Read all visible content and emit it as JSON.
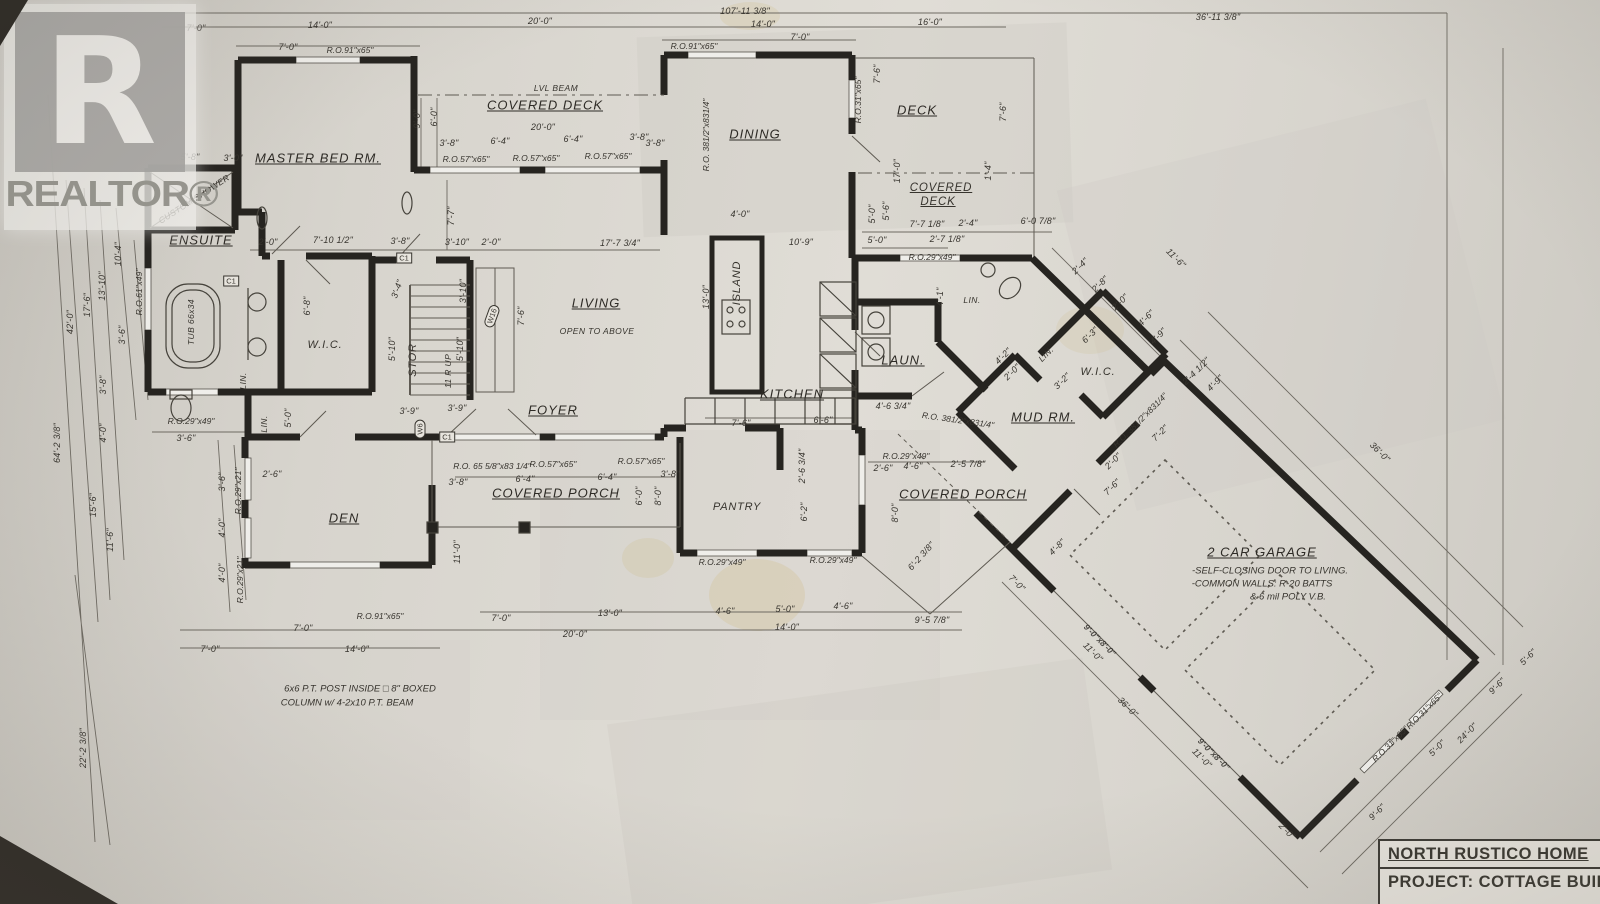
{
  "watermark": {
    "logo_letter": "R",
    "brand": "REALTOR®"
  },
  "title_block": {
    "name": "NORTH RUSTICO HOME",
    "project": "PROJECT: COTTAGE BUILDE"
  },
  "plan": {
    "annotations": [
      {
        "t": "107'-11 3/8\"",
        "x": 745,
        "y": 11
      },
      {
        "t": "7'-0\"",
        "x": 196,
        "y": 28
      },
      {
        "t": "14'-0\"",
        "x": 320,
        "y": 25
      },
      {
        "t": "20'-0\"",
        "x": 540,
        "y": 21
      },
      {
        "t": "14'-0\"",
        "x": 763,
        "y": 24
      },
      {
        "t": "16'-0\"",
        "x": 930,
        "y": 22
      },
      {
        "t": "36'-11 3/8\"",
        "x": 1218,
        "y": 17
      },
      {
        "t": "7'-0\"",
        "x": 288,
        "y": 47
      },
      {
        "t": "R.O.91\"x65\"",
        "x": 350,
        "y": 50,
        "c": "ro"
      },
      {
        "t": "R.O.91\"x65\"",
        "x": 694,
        "y": 46,
        "c": "ro"
      },
      {
        "t": "7'-0\"",
        "x": 800,
        "y": 37
      },
      {
        "t": "LVL BEAM",
        "x": 556,
        "y": 88,
        "c": "sub"
      },
      {
        "t": "COVERED DECK",
        "x": 545,
        "y": 105,
        "c": "room"
      },
      {
        "t": "20'-0\"",
        "x": 543,
        "y": 127
      },
      {
        "t": "3'-8\"",
        "x": 449,
        "y": 143
      },
      {
        "t": "6'-4\"",
        "x": 500,
        "y": 141
      },
      {
        "t": "6'-4\"",
        "x": 573,
        "y": 139
      },
      {
        "t": "3'-8\"",
        "x": 639,
        "y": 137
      },
      {
        "t": "R.O.57\"x65\"",
        "x": 466,
        "y": 159,
        "c": "ro"
      },
      {
        "t": "R.O.57\"x65\"",
        "x": 536,
        "y": 158,
        "c": "ro"
      },
      {
        "t": "R.O.57\"x65\"",
        "x": 608,
        "y": 156,
        "c": "ro"
      },
      {
        "t": "9'-0\"",
        "x": 417,
        "y": 119,
        "r": -90
      },
      {
        "t": "6'-0\"",
        "x": 434,
        "y": 117,
        "r": -90
      },
      {
        "t": "7'-7\"",
        "x": 451,
        "y": 216,
        "r": -90
      },
      {
        "t": "MASTER BED RM.",
        "x": 318,
        "y": 158,
        "c": "room"
      },
      {
        "t": "5'-8\"",
        "x": 190,
        "y": 157
      },
      {
        "t": "3'-0\"",
        "x": 233,
        "y": 158
      },
      {
        "t": "CUSTOM SHOWER",
        "x": 194,
        "y": 199,
        "r": -33,
        "c": "sub"
      },
      {
        "t": "ENSUITE",
        "x": 201,
        "y": 240,
        "c": "room"
      },
      {
        "t": "TUB 66x34",
        "x": 191,
        "y": 322,
        "r": -90,
        "c": "sub"
      },
      {
        "t": "2'-0\"",
        "x": 268,
        "y": 242
      },
      {
        "t": "7'-10 1/2\"",
        "x": 333,
        "y": 240
      },
      {
        "t": "3'-8\"",
        "x": 400,
        "y": 241
      },
      {
        "t": "3'-10\"",
        "x": 457,
        "y": 242
      },
      {
        "t": "2'-0\"",
        "x": 491,
        "y": 242
      },
      {
        "t": "17'-7 3/4\"",
        "x": 620,
        "y": 243
      },
      {
        "t": "W.I.C.",
        "x": 325,
        "y": 345,
        "c": "roomp"
      },
      {
        "t": "6'-8\"",
        "x": 307,
        "y": 306,
        "r": -90
      },
      {
        "t": "LIN.",
        "x": 243,
        "y": 381,
        "r": -90,
        "c": "sub"
      },
      {
        "t": "LIN.",
        "x": 264,
        "y": 424,
        "r": -90,
        "c": "sub"
      },
      {
        "t": "5'-0\"",
        "x": 288,
        "y": 418,
        "r": -90
      },
      {
        "t": "R.O.29\"x49\"",
        "x": 191,
        "y": 421,
        "c": "ro"
      },
      {
        "t": "3'-6\"",
        "x": 186,
        "y": 438
      },
      {
        "t": "9'-0\"",
        "x": 62,
        "y": 106,
        "r": -90
      },
      {
        "t": "42'-0\"",
        "x": 70,
        "y": 322,
        "r": -90
      },
      {
        "t": "17'-6\"",
        "x": 87,
        "y": 305,
        "r": -90
      },
      {
        "t": "13'-10\"",
        "x": 102,
        "y": 286,
        "r": -90
      },
      {
        "t": "10'-4\"",
        "x": 118,
        "y": 254,
        "r": -90
      },
      {
        "t": "R.O.61\"x49\"",
        "x": 139,
        "y": 292,
        "r": -90,
        "c": "ro"
      },
      {
        "t": "3'-6\"",
        "x": 122,
        "y": 335,
        "r": -90
      },
      {
        "t": "3'-8\"",
        "x": 103,
        "y": 385,
        "r": -90
      },
      {
        "t": "4'-0\"",
        "x": 103,
        "y": 433,
        "r": -90
      },
      {
        "t": "64'-2 3/8\"",
        "x": 57,
        "y": 443,
        "r": -90
      },
      {
        "t": "15'-6\"",
        "x": 93,
        "y": 505,
        "r": -90
      },
      {
        "t": "11'-6\"",
        "x": 110,
        "y": 540,
        "r": -90
      },
      {
        "t": "22'-2 3/8\"",
        "x": 83,
        "y": 748,
        "r": -90
      },
      {
        "t": "3'-6\"",
        "x": 222,
        "y": 482,
        "r": -90
      },
      {
        "t": "R.O.29\"x21\"",
        "x": 238,
        "y": 491,
        "r": -90,
        "c": "ro"
      },
      {
        "t": "4'-0\"",
        "x": 222,
        "y": 528,
        "r": -90
      },
      {
        "t": "4'-0\"",
        "x": 222,
        "y": 573,
        "r": -90
      },
      {
        "t": "R.O.29\"x21\"",
        "x": 240,
        "y": 580,
        "r": -90,
        "c": "ro"
      },
      {
        "t": "STOR",
        "x": 413,
        "y": 360,
        "r": -90,
        "c": "roomp"
      },
      {
        "t": "5'-10\"",
        "x": 392,
        "y": 349,
        "r": -90
      },
      {
        "t": "5'-10\"",
        "x": 460,
        "y": 349,
        "r": -90
      },
      {
        "t": "11 R UP",
        "x": 448,
        "y": 371,
        "r": -90,
        "c": "sub"
      },
      {
        "t": "3'-10\"",
        "x": 463,
        "y": 291,
        "r": -90
      },
      {
        "t": "3'-4\"",
        "x": 397,
        "y": 289,
        "r": -70
      },
      {
        "t": "7'-6\"",
        "x": 521,
        "y": 316,
        "r": -90
      },
      {
        "t": "3'-9\"",
        "x": 409,
        "y": 411
      },
      {
        "t": "3'-9\"",
        "x": 457,
        "y": 408
      },
      {
        "t": "LIVING",
        "x": 596,
        "y": 303,
        "c": "room"
      },
      {
        "t": "OPEN TO ABOVE",
        "x": 597,
        "y": 331,
        "c": "sub"
      },
      {
        "t": "FOYER",
        "x": 553,
        "y": 410,
        "c": "room"
      },
      {
        "t": "13'-0\"",
        "x": 706,
        "y": 297,
        "r": -90
      },
      {
        "t": "ISLAND",
        "x": 737,
        "y": 283,
        "r": -90,
        "c": "roomp"
      },
      {
        "t": "4'-0\"",
        "x": 740,
        "y": 214
      },
      {
        "t": "10'-9\"",
        "x": 801,
        "y": 242
      },
      {
        "t": "DINING",
        "x": 755,
        "y": 134,
        "c": "room"
      },
      {
        "t": "R.O. 381/2\"x831/4\"",
        "x": 706,
        "y": 135,
        "r": -90,
        "c": "ro"
      },
      {
        "t": "3'-8\"",
        "x": 655,
        "y": 143
      },
      {
        "t": "DECK",
        "x": 917,
        "y": 110,
        "c": "room"
      },
      {
        "t": "R.O.31\"x65\"",
        "x": 858,
        "y": 100,
        "r": -90,
        "c": "ro"
      },
      {
        "t": "7'-6\"",
        "x": 877,
        "y": 74,
        "r": -90
      },
      {
        "t": "7'-6\"",
        "x": 1003,
        "y": 112,
        "r": -90
      },
      {
        "t": "17'-0\"",
        "x": 897,
        "y": 171,
        "r": -90
      },
      {
        "t": "1'-4\"",
        "x": 988,
        "y": 171,
        "r": -90
      },
      {
        "t": "COVERED",
        "x": 941,
        "y": 188,
        "c": "room2"
      },
      {
        "t": "DECK",
        "x": 938,
        "y": 202,
        "c": "room2"
      },
      {
        "t": "7'-7 1/8\"",
        "x": 927,
        "y": 224
      },
      {
        "t": "2'-4\"",
        "x": 968,
        "y": 223
      },
      {
        "t": "6'-0 7/8\"",
        "x": 1038,
        "y": 221
      },
      {
        "t": "5'-0\"",
        "x": 877,
        "y": 240
      },
      {
        "t": "2'-7 1/8\"",
        "x": 947,
        "y": 239
      },
      {
        "t": "R.O.29\"x49\"",
        "x": 932,
        "y": 257,
        "c": "ro"
      },
      {
        "t": "5'-0\"",
        "x": 872,
        "y": 214,
        "r": -90
      },
      {
        "t": "5'-6\"",
        "x": 886,
        "y": 211,
        "r": -90
      },
      {
        "t": "KITCHEN",
        "x": 792,
        "y": 394,
        "c": "room"
      },
      {
        "t": "7'-6\"",
        "x": 741,
        "y": 423
      },
      {
        "t": "6'-6\"",
        "x": 823,
        "y": 420
      },
      {
        "t": "4'-6 3/4\"",
        "x": 893,
        "y": 406
      },
      {
        "t": "2'-6 3/4\"",
        "x": 802,
        "y": 466,
        "r": -90
      },
      {
        "t": "6'-2\"",
        "x": 804,
        "y": 512,
        "r": -90
      },
      {
        "t": "4'-1\"",
        "x": 940,
        "y": 297,
        "r": -90
      },
      {
        "t": "LIN.",
        "x": 972,
        "y": 300,
        "c": "sub"
      },
      {
        "t": "PANTRY",
        "x": 737,
        "y": 507,
        "c": "roomp"
      },
      {
        "t": "LAUN.",
        "x": 903,
        "y": 360,
        "c": "room"
      },
      {
        "t": "R.O. 381/2\"x831/4\"",
        "x": 958,
        "y": 420,
        "r": 8,
        "c": "ro"
      },
      {
        "t": "MUD RM.",
        "x": 1043,
        "y": 417,
        "c": "room"
      },
      {
        "t": "R.O.29\"x49\"",
        "x": 906,
        "y": 456,
        "c": "ro"
      },
      {
        "t": "2'-6\"",
        "x": 883,
        "y": 468
      },
      {
        "t": "4'-6\"",
        "x": 913,
        "y": 466
      },
      {
        "t": "2'-5 7/8\"",
        "x": 968,
        "y": 464
      },
      {
        "t": "8'-0\"",
        "x": 895,
        "y": 513,
        "r": -90
      },
      {
        "t": "COVERED PORCH",
        "x": 963,
        "y": 494,
        "c": "room"
      },
      {
        "t": "6'-2 3/8\"",
        "x": 921,
        "y": 556,
        "r": -48
      },
      {
        "t": "DEN",
        "x": 344,
        "y": 518,
        "c": "room"
      },
      {
        "t": "2'-6\"",
        "x": 272,
        "y": 474
      },
      {
        "t": "COVERED PORCH",
        "x": 556,
        "y": 493,
        "c": "room"
      },
      {
        "t": "R.O. 65 5/8\"x83 1/4\"",
        "x": 492,
        "y": 466,
        "c": "ro"
      },
      {
        "t": "3'-8\"",
        "x": 458,
        "y": 482
      },
      {
        "t": "R.O.57\"x65\"",
        "x": 553,
        "y": 464,
        "c": "ro"
      },
      {
        "t": "R.O.57\"x65\"",
        "x": 641,
        "y": 461,
        "c": "ro"
      },
      {
        "t": "6'-4\"",
        "x": 525,
        "y": 479
      },
      {
        "t": "6'-4\"",
        "x": 607,
        "y": 477
      },
      {
        "t": "3'-8\"",
        "x": 670,
        "y": 474
      },
      {
        "t": "6'-0\"",
        "x": 639,
        "y": 496,
        "r": -90
      },
      {
        "t": "8'-0\"",
        "x": 658,
        "y": 496,
        "r": -90
      },
      {
        "t": "11'-0\"",
        "x": 457,
        "y": 552,
        "r": -90
      },
      {
        "t": "R.O.91\"x65\"",
        "x": 380,
        "y": 616,
        "c": "ro"
      },
      {
        "t": "7'-0\"",
        "x": 303,
        "y": 628
      },
      {
        "t": "14'-0\"",
        "x": 357,
        "y": 649
      },
      {
        "t": "7'-0\"",
        "x": 210,
        "y": 649
      },
      {
        "t": "7'-0\"",
        "x": 501,
        "y": 618
      },
      {
        "t": "13'-0\"",
        "x": 610,
        "y": 613
      },
      {
        "t": "20'-0\"",
        "x": 575,
        "y": 634
      },
      {
        "t": "R.O.29\"x49\"",
        "x": 722,
        "y": 562,
        "c": "ro"
      },
      {
        "t": "R.O.29\"x49\"",
        "x": 833,
        "y": 560,
        "c": "ro"
      },
      {
        "t": "4'-6\"",
        "x": 725,
        "y": 611
      },
      {
        "t": "5'-0\"",
        "x": 785,
        "y": 609
      },
      {
        "t": "4'-6\"",
        "x": 843,
        "y": 606
      },
      {
        "t": "14'-0\"",
        "x": 787,
        "y": 627
      },
      {
        "t": "9'-5 7/8\"",
        "x": 932,
        "y": 620
      },
      {
        "t": "6x6 P.T. POST INSIDE □ 8\" BOXED",
        "x": 360,
        "y": 689,
        "c": "note"
      },
      {
        "t": "COLUMN w/ 4-2x10 P.T. BEAM",
        "x": 347,
        "y": 703,
        "c": "note"
      },
      {
        "t": "11'-6\"",
        "x": 1176,
        "y": 258,
        "r": 45
      },
      {
        "t": "2'-4\"",
        "x": 1080,
        "y": 266,
        "r": -45
      },
      {
        "t": "2'-8\"",
        "x": 1100,
        "y": 284,
        "r": -45
      },
      {
        "t": "2'-0\"",
        "x": 1120,
        "y": 302,
        "r": -45
      },
      {
        "t": "4'-6\"",
        "x": 1146,
        "y": 318,
        "r": -45
      },
      {
        "t": "4'-9\"",
        "x": 1158,
        "y": 336,
        "r": -45
      },
      {
        "t": "6'-3\"",
        "x": 1090,
        "y": 335,
        "r": -45
      },
      {
        "t": "3'-2\"",
        "x": 1062,
        "y": 381,
        "r": -45
      },
      {
        "t": "4'-2\"",
        "x": 1003,
        "y": 356,
        "r": -45
      },
      {
        "t": "2'-0\"",
        "x": 1012,
        "y": 372,
        "r": -45
      },
      {
        "t": "LIN.",
        "x": 1046,
        "y": 354,
        "r": -45,
        "c": "sub"
      },
      {
        "t": "W.I.C.",
        "x": 1098,
        "y": 372,
        "c": "roomp"
      },
      {
        "t": "R.O. 381/2\"x831/4\"",
        "x": 1140,
        "y": 420,
        "r": -45,
        "c": "ro"
      },
      {
        "t": "2'-4 1/2\"",
        "x": 1196,
        "y": 371,
        "r": -45
      },
      {
        "t": "4'-9\"",
        "x": 1215,
        "y": 383,
        "r": -45
      },
      {
        "t": "7'-2\"",
        "x": 1160,
        "y": 433,
        "r": -45
      },
      {
        "t": "2'-0\"",
        "x": 1113,
        "y": 461,
        "r": -45
      },
      {
        "t": "7'-6\"",
        "x": 1112,
        "y": 487,
        "r": -45
      },
      {
        "t": "4'-8\"",
        "x": 1057,
        "y": 547,
        "r": -45
      },
      {
        "t": "7'-0\"",
        "x": 1017,
        "y": 583,
        "r": 45
      },
      {
        "t": "2 CAR GARAGE",
        "x": 1262,
        "y": 552,
        "c": "room"
      },
      {
        "t": "-SELF-CLOSING DOOR TO LIVING.",
        "x": 1270,
        "y": 571,
        "c": "note"
      },
      {
        "t": "-COMMON WALLS: R-20 BATTS",
        "x": 1262,
        "y": 584,
        "c": "note"
      },
      {
        "t": "& 6 mil POLY V.B.",
        "x": 1288,
        "y": 597,
        "c": "note"
      },
      {
        "t": "36'-0\"",
        "x": 1380,
        "y": 452,
        "r": 45
      },
      {
        "t": "36'-0\"",
        "x": 1128,
        "y": 707,
        "r": 45
      },
      {
        "t": "11'-0\"",
        "x": 1093,
        "y": 652,
        "r": 45
      },
      {
        "t": "11'-0\"",
        "x": 1202,
        "y": 758,
        "r": 45
      },
      {
        "t": "2'-0\"",
        "x": 1287,
        "y": 831,
        "r": 45
      },
      {
        "t": "9'-0\"x8'-0\"",
        "x": 1100,
        "y": 640,
        "r": 45,
        "c": "wall"
      },
      {
        "t": "9'-0\"x8'-0\"",
        "x": 1214,
        "y": 754,
        "r": 45,
        "c": "wall"
      },
      {
        "t": "R.O.31\"x65\"",
        "x": 1390,
        "y": 744,
        "r": -45,
        "c": "ro"
      },
      {
        "t": "R.O.31\"x65\"",
        "x": 1424,
        "y": 711,
        "r": -45,
        "c": "ro"
      },
      {
        "t": "9'-6\"",
        "x": 1377,
        "y": 812,
        "r": -45
      },
      {
        "t": "5'-0\"",
        "x": 1437,
        "y": 748,
        "r": -45
      },
      {
        "t": "24'-0\"",
        "x": 1467,
        "y": 733,
        "r": -45
      },
      {
        "t": "9'-6\"",
        "x": 1497,
        "y": 686,
        "r": -45
      },
      {
        "t": "5'-6\"",
        "x": 1528,
        "y": 657,
        "r": -45
      },
      {
        "t": "C1",
        "x": 404,
        "y": 258,
        "c": "tag"
      },
      {
        "t": "C1",
        "x": 447,
        "y": 437,
        "c": "tag"
      },
      {
        "t": "C1",
        "x": 231,
        "y": 281,
        "c": "tag"
      },
      {
        "t": "W6",
        "x": 420,
        "y": 429,
        "r": -90,
        "c": "tago"
      },
      {
        "t": "W16",
        "x": 492,
        "y": 316,
        "r": -70,
        "c": "tago"
      }
    ]
  }
}
